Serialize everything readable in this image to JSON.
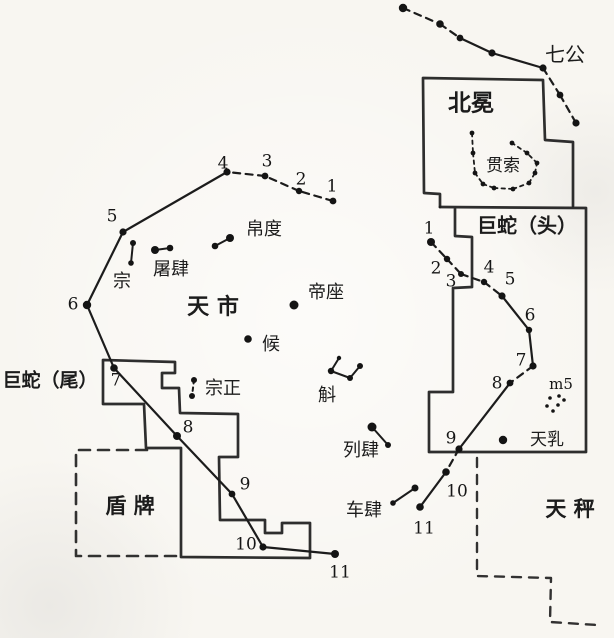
{
  "canvas": {
    "width": 614,
    "height": 638,
    "paper": "#f8f6f1",
    "ink": "#1c1c1c"
  },
  "labels": [
    {
      "id": "qigong",
      "text": "七公",
      "x": 565,
      "y": 56,
      "size": 20,
      "bold": false
    },
    {
      "id": "beimian",
      "text": "北冕",
      "x": 471,
      "y": 104,
      "size": 23,
      "bold": true
    },
    {
      "id": "guansuo",
      "text": "贯索",
      "x": 503,
      "y": 166,
      "size": 17,
      "bold": false
    },
    {
      "id": "jushe-tou",
      "text": "巨蛇（头）",
      "x": 527,
      "y": 227,
      "size": 20,
      "bold": true
    },
    {
      "id": "bodu",
      "text": "帛度",
      "x": 264,
      "y": 230,
      "size": 18,
      "bold": false
    },
    {
      "id": "tusi",
      "text": "屠肆",
      "x": 171,
      "y": 270,
      "size": 18,
      "bold": false
    },
    {
      "id": "zong",
      "text": "宗",
      "x": 122,
      "y": 282,
      "size": 18,
      "bold": false
    },
    {
      "id": "tianshi",
      "text": "天 市",
      "x": 213,
      "y": 308,
      "size": 22,
      "bold": true
    },
    {
      "id": "dizuo",
      "text": "帝座",
      "x": 326,
      "y": 293,
      "size": 18,
      "bold": false
    },
    {
      "id": "hou",
      "text": "候",
      "x": 271,
      "y": 345,
      "size": 18,
      "bold": false
    },
    {
      "id": "hu",
      "text": "斛",
      "x": 327,
      "y": 396,
      "size": 18,
      "bold": false
    },
    {
      "id": "zongzheng",
      "text": "宗正",
      "x": 223,
      "y": 389,
      "size": 18,
      "bold": false
    },
    {
      "id": "liesi",
      "text": "列肆",
      "x": 361,
      "y": 451,
      "size": 18,
      "bold": false
    },
    {
      "id": "chesi",
      "text": "车肆",
      "x": 364,
      "y": 511,
      "size": 18,
      "bold": false
    },
    {
      "id": "jushe-wei",
      "text": "巨蛇（尾）",
      "x": 50,
      "y": 381,
      "size": 19,
      "bold": true
    },
    {
      "id": "dunpai",
      "text": "盾 牌",
      "x": 130,
      "y": 507,
      "size": 21,
      "bold": true
    },
    {
      "id": "tianru",
      "text": "天乳",
      "x": 547,
      "y": 440,
      "size": 17,
      "bold": false
    },
    {
      "id": "m5",
      "text": "m5",
      "x": 561,
      "y": 385,
      "size": 15,
      "bold": false,
      "serif": true
    },
    {
      "id": "tiancheng",
      "text": "天 秤",
      "x": 570,
      "y": 510,
      "size": 21,
      "bold": true
    }
  ],
  "chains": [
    {
      "name": "left-snake-body",
      "stars": [
        [
          333,
          201,
          3.4
        ],
        [
          299,
          191,
          3.2
        ],
        [
          265,
          176,
          3.4
        ],
        [
          227,
          172,
          3.6
        ],
        [
          123,
          232,
          3.6
        ],
        [
          87,
          305,
          4.2
        ],
        [
          114,
          368,
          3.8
        ],
        [
          177,
          436,
          4.0
        ],
        [
          232,
          494,
          3.4
        ],
        [
          263,
          547,
          3.6
        ],
        [
          335,
          554,
          4.0
        ]
      ],
      "segments": [
        "dashed",
        "dashed",
        "dashed",
        "solid",
        "solid",
        "solid",
        "solid",
        "solid",
        "solid",
        "solid"
      ],
      "numbers": [
        [
          "1",
          332,
          187
        ],
        [
          "2",
          301,
          180
        ],
        [
          "3",
          267,
          162
        ],
        [
          "4",
          223,
          164
        ],
        [
          "5",
          112,
          217
        ],
        [
          "6",
          73,
          305
        ],
        [
          "7",
          116,
          381
        ],
        [
          "8",
          188,
          428
        ],
        [
          "9",
          245,
          485
        ],
        [
          "10",
          246,
          545
        ],
        [
          "11",
          340,
          573
        ]
      ]
    },
    {
      "name": "right-snake-head",
      "stars": [
        [
          431,
          242,
          4.0
        ],
        [
          447,
          259,
          3.2
        ],
        [
          461,
          274,
          3.0
        ],
        [
          484,
          282,
          3.2
        ],
        [
          502,
          296,
          3.6
        ],
        [
          529,
          330,
          3.2
        ],
        [
          533,
          366,
          3.6
        ],
        [
          510,
          383,
          3.4
        ],
        [
          459,
          449,
          3.6
        ],
        [
          446,
          472,
          3.8
        ],
        [
          420,
          507,
          3.8
        ]
      ],
      "segments": [
        "dashed",
        "dashed",
        "dashed",
        "dashed",
        "solid",
        "solid",
        "dashed",
        "solid",
        "dashed",
        "solid"
      ],
      "numbers": [
        [
          "1",
          429,
          229
        ],
        [
          "2",
          436,
          269
        ],
        [
          "3",
          451,
          282
        ],
        [
          "4",
          489,
          268
        ],
        [
          "5",
          510,
          280
        ],
        [
          "6",
          530,
          316
        ],
        [
          "7",
          521,
          361
        ],
        [
          "8",
          497,
          384
        ],
        [
          "9",
          451,
          439
        ],
        [
          "10",
          457,
          492
        ],
        [
          "11",
          424,
          529
        ]
      ]
    },
    {
      "name": "seven-dukes",
      "stars": [
        [
          403,
          8,
          4.2
        ],
        [
          440,
          24,
          3.8
        ],
        [
          460,
          38,
          3.4
        ],
        [
          492,
          53,
          3.6
        ],
        [
          543,
          68,
          3.6
        ],
        [
          560,
          95,
          3.4
        ],
        [
          576,
          123,
          3.6
        ]
      ],
      "segments": [
        "dashed",
        "dashed",
        "solid",
        "solid",
        "dashed",
        "dashed"
      ],
      "numbers": []
    },
    {
      "name": "guansuo-circlet",
      "stars": [
        [
          472,
          133,
          2.4
        ],
        [
          473,
          153,
          2.4
        ],
        [
          475,
          173,
          2.4
        ],
        [
          483,
          184,
          2.4
        ],
        [
          494,
          188,
          2.4
        ],
        [
          513,
          189,
          2.4
        ],
        [
          529,
          183,
          2.4
        ],
        [
          535,
          173,
          2.4
        ],
        [
          537,
          163,
          2.4
        ],
        [
          527,
          153,
          2.4
        ],
        [
          512,
          143,
          2.4
        ]
      ],
      "segments": [
        "dotted",
        "dotted",
        "dotted",
        "dotted",
        "dotted",
        "dotted",
        "dotted",
        "dotted",
        "dotted",
        "dotted"
      ],
      "numbers": [],
      "thin": true
    }
  ],
  "asterisms": [
    {
      "name": "bodu-pair",
      "stars": [
        [
          215,
          246,
          3.3
        ],
        [
          230,
          238,
          4.0
        ]
      ],
      "connect": "polyline",
      "style": "solid"
    },
    {
      "name": "tusi-pair",
      "stars": [
        [
          155,
          250,
          4.0
        ],
        [
          170,
          248,
          3.3
        ]
      ],
      "connect": "polyline",
      "style": "solid"
    },
    {
      "name": "zong-pair",
      "stars": [
        [
          133,
          243,
          3.0
        ],
        [
          131,
          263,
          2.8
        ]
      ],
      "connect": "polyline",
      "style": "solid"
    },
    {
      "name": "zongzheng-pair",
      "stars": [
        [
          194,
          380,
          3.0
        ],
        [
          192,
          396,
          3.0
        ]
      ],
      "connect": "polyline",
      "style": "dotted"
    },
    {
      "name": "hu-zigzag",
      "stars": [
        [
          339,
          358,
          2.2
        ],
        [
          331,
          371,
          3.2
        ],
        [
          350,
          378,
          3.0
        ],
        [
          360,
          366,
          3.0
        ]
      ],
      "connect": "polyline",
      "style": "solid"
    },
    {
      "name": "liesi-pair",
      "stars": [
        [
          372,
          427,
          4.5
        ],
        [
          388,
          445,
          3.0
        ]
      ],
      "connect": "polyline",
      "style": "solid"
    },
    {
      "name": "chesi-pair",
      "stars": [
        [
          393,
          503,
          2.8
        ],
        [
          415,
          488,
          3.5
        ]
      ],
      "connect": "polyline",
      "style": "solid"
    },
    {
      "name": "dizuo-star",
      "stars": [
        [
          294,
          305,
          4.5
        ]
      ],
      "connect": "none",
      "style": "solid"
    },
    {
      "name": "hou-star",
      "stars": [
        [
          248,
          339,
          3.8
        ]
      ],
      "connect": "none",
      "style": "solid"
    },
    {
      "name": "tianru-star",
      "stars": [
        [
          503,
          440,
          4.2
        ]
      ],
      "connect": "none",
      "style": "solid"
    },
    {
      "name": "m5-cluster",
      "stars": [
        [
          550,
          398,
          1.8
        ],
        [
          559,
          396,
          1.8
        ],
        [
          564,
          400,
          1.8
        ],
        [
          547,
          406,
          1.8
        ],
        [
          558,
          405,
          1.8
        ],
        [
          553,
          411,
          1.8
        ]
      ],
      "connect": "none",
      "style": "solid"
    }
  ],
  "walls": [
    {
      "name": "corona-borealis-box",
      "d": "M440,207 L440,194 L424,193 L423,78 L543,80 L545,140 L573,142 L573,206",
      "width": 2.7
    },
    {
      "name": "serpens-head-box",
      "d": "M440,207 L586,208 L586,452 L429,452 L429,392 L453,392 L453,288 L472,287 L472,237 L455,236 L455,209",
      "width": 2.7
    },
    {
      "name": "market-enclosure",
      "d": "M103,360 L175,362 L175,373 L162,373 L162,388 L179,388 L180,413 L238,414 L238,457 L219,457 L220,520 L265,520 L265,533 L282,533 L282,523 L310,523 L310,558 L181,557 L181,448 L146,448 L144,404 L103,404 Z",
      "width": 2.7
    }
  ],
  "dashed_borders": [
    {
      "name": "shield-box",
      "d": "M147,450 L76,450 L76,556 L177,556",
      "width": 2.6,
      "dash": "11 8"
    },
    {
      "name": "libra-border",
      "d": "M477,458 L477,576 L551,578 L550,622 L597,625",
      "width": 2.4,
      "dash": "9 8"
    }
  ]
}
